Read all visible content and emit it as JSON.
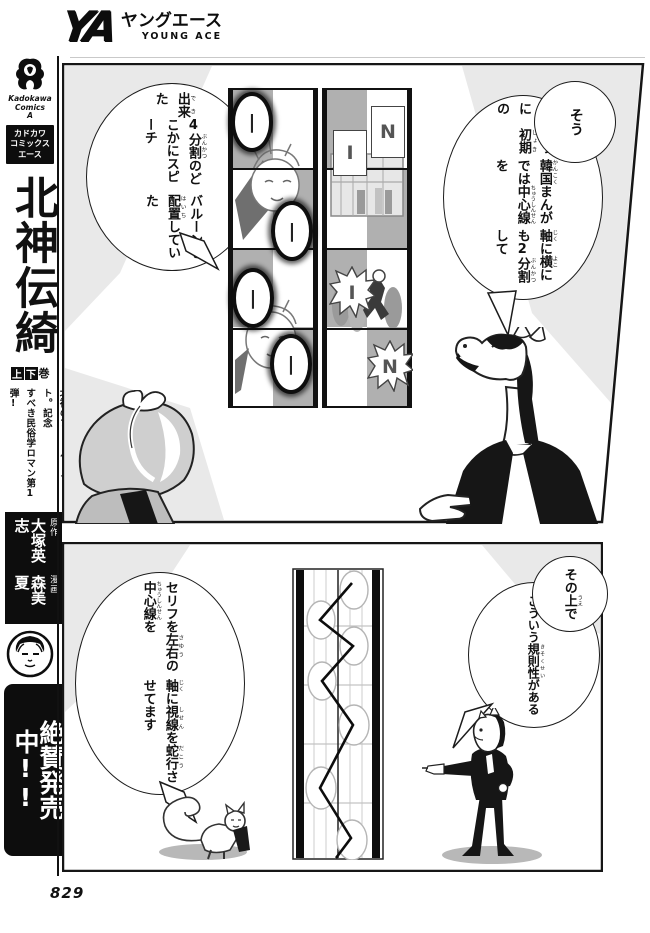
{
  "colors": {
    "ink": "#111111",
    "paper": "#ffffff",
    "tone_gray": "#b0b0b0",
    "wash_gray": "#e9e9e9"
  },
  "magazine": {
    "logo_ya": "YA",
    "logo_kana": "ヤングエース",
    "logo_en": "YOUNG ACE"
  },
  "sidebar": {
    "publisher_logo_icon": "kadokawa-phoenix-logo",
    "publisher_lines": [
      "Kadokawa",
      "Comics",
      "A"
    ],
    "imprint_lines": [
      "カドカワ",
      "コミックス",
      "エース"
    ],
    "series_title": "北神伝綺",
    "volume_badge": {
      "upper": "上",
      "lower": "下",
      "kan": "巻"
    },
    "tagline_lines": [
      "先住民〝山人〟の血を引く兵藤",
      "北神のフィールドノート。記念",
      "すべき民俗学ロマン第1弾!"
    ],
    "credits": [
      {
        "role": "原作",
        "name": "大塚英志"
      },
      {
        "role": "漫画",
        "name": "森美夏"
      }
    ],
    "portrait_icon": "author-portrait",
    "banner": "絶賛発売中!!",
    "page_number": "829"
  },
  "panel1": {
    "bubble_right": {
      "intro": "そう",
      "lines": [
        "このように　初期[しょき]の",
        "韓国[かんこく]まんがでは中心線[ちゅうしんせん]を",
        "軸[じく]に横[よこ]にも2分割[ぶんかつ]して"
      ]
    },
    "bubble_left": {
      "lines": [
        "出来[でき]た",
        "4分割[ぶんかつ]のどこかにスピーチ",
        "バルーンを配置[はいち]していた"
      ]
    },
    "diagram": {
      "left_strip_balloons": [
        "|",
        "|",
        "|",
        "|"
      ],
      "right_strip_balloons": [
        "I",
        "N",
        "I",
        "N"
      ]
    },
    "characters": [
      "horse-headed-lecturer",
      "bundled-head-listener"
    ]
  },
  "panel2": {
    "bubble_right": {
      "intro": "その上[うえ]で",
      "lines": [
        "こういう規則性[きそくせい]がある"
      ]
    },
    "bubble_left": {
      "lines": [
        "セリフを左右[さゆう]の中心線[ちゅうしんせん]を",
        "軸[じく]に視線[しせん]を蛇行[だこう]させてます"
      ]
    },
    "characters": [
      "walking-cat",
      "pointing-horse-man"
    ]
  }
}
